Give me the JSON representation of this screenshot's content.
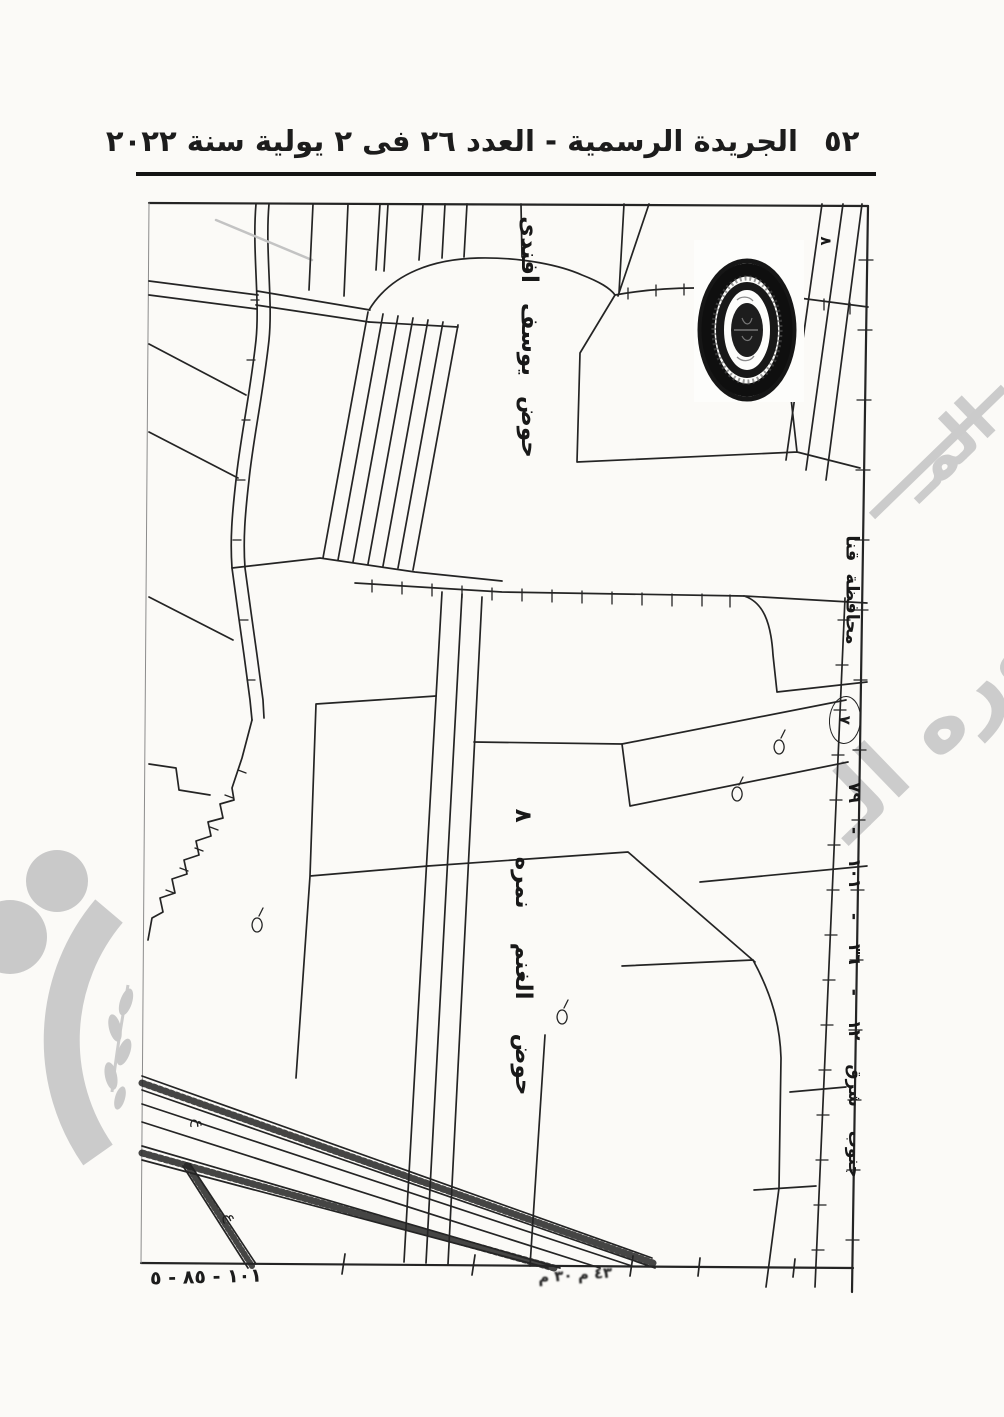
{
  "document": {
    "header": {
      "title": "الجريدة الرسمية - العدد ٢٦ فى ٢ يولية سنة ٢٠٢٢",
      "page_number": "٥٢"
    },
    "map": {
      "labels": {
        "hod_top": "حوض يوسف افندى",
        "hod_bottom": "حوض الغنم نمره ٨",
        "governorate": "محافظة قنا",
        "sheet_direction": "جنوب شرق ١٢ - ٣٦ - ١٠١ - ٧٩",
        "corner_number": "٨",
        "circled_number": "٧",
        "bottom_left_numbers": "١٠١ - ٨٥ - ٥",
        "bottom_center_marks": "٤٣ م ٣٠ م",
        "survey_mark": "ع"
      }
    },
    "watermark": {
      "fragment_upper": "المـ",
      "fragment_lower": "صوره الـ"
    },
    "colors": {
      "ink": "#242424",
      "paper": "#fbfaf7",
      "watermark": "#c8c8c8"
    }
  }
}
